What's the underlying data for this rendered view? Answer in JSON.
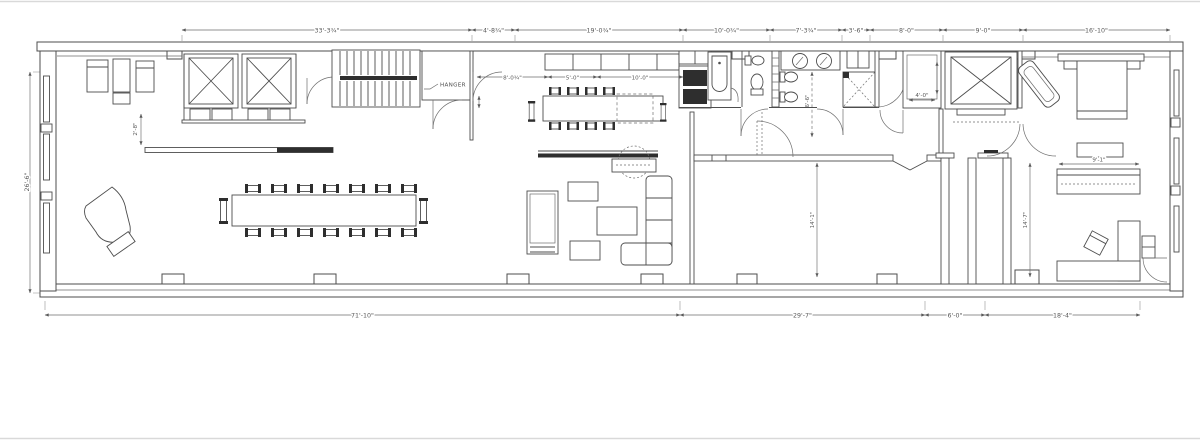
{
  "page": {
    "background": "#ffffff",
    "frame_line_color": "#d9d9d9"
  },
  "plan": {
    "ink": "#4d4d4d",
    "dim_ink": "#5a5a5a",
    "dark_fill": "#2e2e2e",
    "labels": {
      "hanger": "HANGER"
    },
    "dimensions": {
      "top": [
        "33'-3¾\"",
        "4'-8¾\"",
        "19'-0¾\"",
        "10'-0¾\"",
        "7'-3¾\"",
        "3'-6\"",
        "8'-0\"",
        "9'-0\"",
        "16'-10\""
      ],
      "bottom": [
        "71'-10\"",
        "29'-7\"",
        "6'-0\"",
        "18'-4\""
      ],
      "left": [
        "26'-6\""
      ],
      "interior": {
        "kitchen": [
          "8'-0¾\"",
          "5'-0\"",
          "10'-0\""
        ],
        "bath_wall": "6'-6\"",
        "closet": "4'-0\"",
        "great_room": "14'-1\"",
        "partition": "14'-7\"",
        "bench": "2'-8\"",
        "bed_wall": "9'-1\""
      }
    }
  }
}
